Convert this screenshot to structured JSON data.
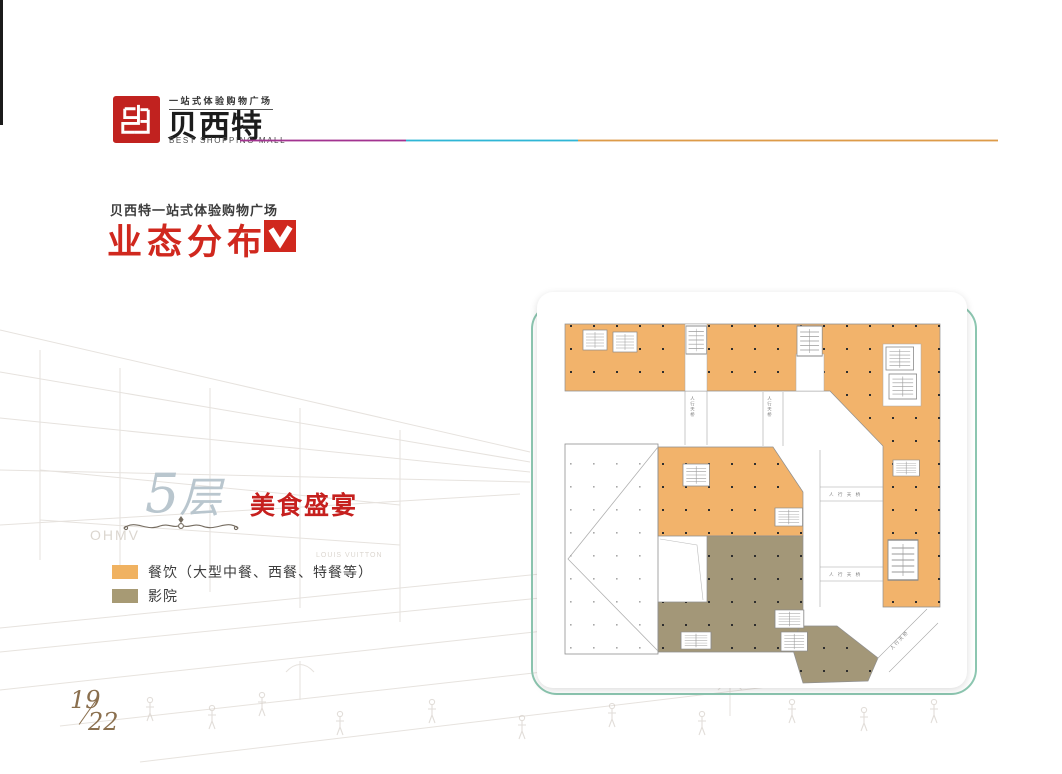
{
  "header": {
    "logo": {
      "tagline": "一站式体验购物广场",
      "brand": "贝西特",
      "subtitle": "BEST SHOPPING MALL",
      "logo_red": "#c1221f"
    },
    "rule_colors": {
      "purple": "#a23390",
      "cyan": "#30b6d6",
      "orange": "#dd9b49"
    }
  },
  "title_block": {
    "eyebrow": "贝西特一站式体验购物广场",
    "title": "业态分布",
    "accent_color": "#d0281e"
  },
  "floor": {
    "number": "5",
    "suffix": "层",
    "theme": "美食盛宴",
    "theme_color": "#c6201e"
  },
  "legend": {
    "items": [
      {
        "label": "餐饮（大型中餐、西餐、特餐等）",
        "color": "#f0b261"
      },
      {
        "label": "影院",
        "color": "#a79a74"
      }
    ]
  },
  "plan": {
    "bridge_label": "人行天桥",
    "bridge_label_spaced": "人 行 天 桥",
    "dining_color": "#f2b36b",
    "cinema_color": "#a39778",
    "frame_color": "#8cc6b0"
  },
  "background": {
    "sign_left": "OHMV",
    "sign_right": "LOUIS VUITTON"
  },
  "page": {
    "number": "19",
    "total": "22"
  }
}
